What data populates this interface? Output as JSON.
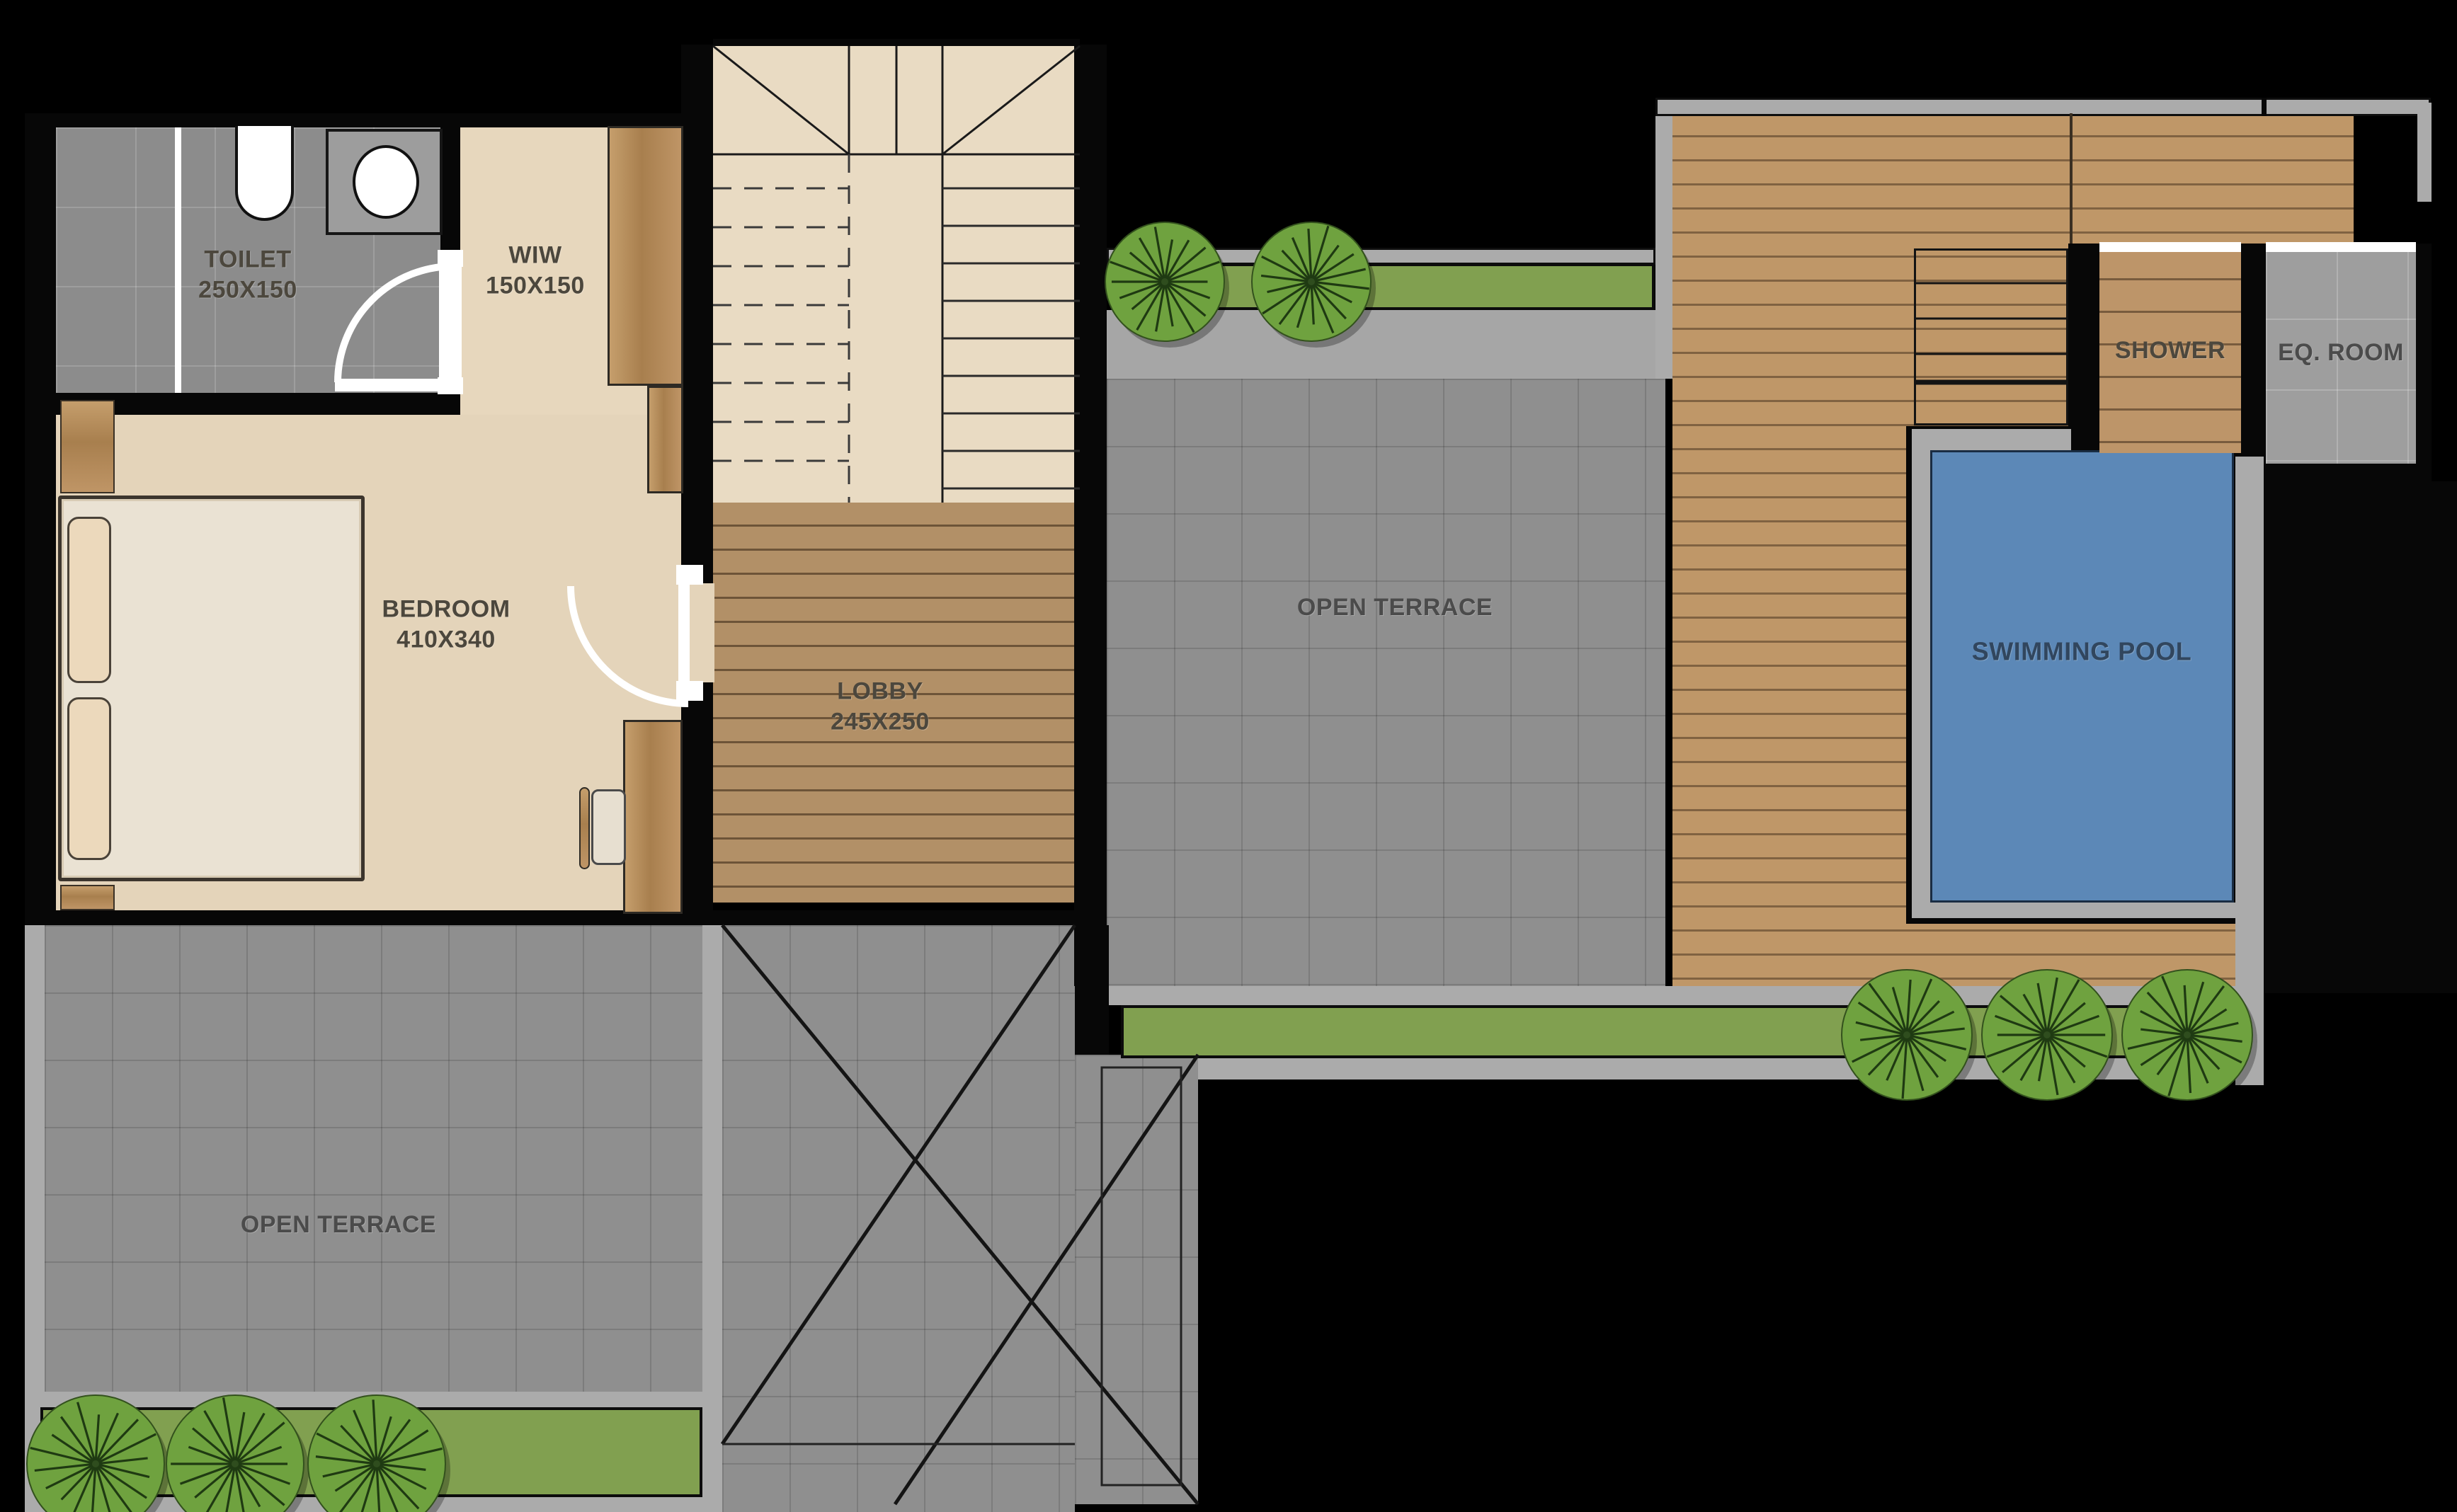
{
  "rooms": {
    "toilet": {
      "label": "TOILET",
      "dimensions": "250X150"
    },
    "wiw": {
      "label": "WIW",
      "dimensions": "150X150"
    },
    "bedroom": {
      "label": "BEDROOM",
      "dimensions": "410X340"
    },
    "lobby": {
      "label": "LOBBY",
      "dimensions": "245X250"
    },
    "open_terrace_mid": {
      "label": "OPEN TERRACE"
    },
    "open_terrace_left": {
      "label": "OPEN TERRACE"
    },
    "swimming_pool": {
      "label": "SWIMMING POOL"
    },
    "shower": {
      "label": "SHOWER"
    },
    "eq_room": {
      "label": "EQ. ROOM"
    }
  },
  "colors": {
    "background_wall": "#070707",
    "tile_gray": "#8f8f8f",
    "concrete_gray": "#ababab",
    "deck_wood": "#bf9768",
    "lobby_wood": "#b29067",
    "floor_beige": "#e7d7bd",
    "planter_green": "#81a050",
    "tree_green": "#6fa23f",
    "pool_blue": "#5c88b7",
    "label_dark": "#4c473d",
    "pool_label": "#31465e"
  },
  "landscape": {
    "trees_top_count": 2,
    "trees_bottom_middle_count": 3,
    "trees_bottom_left_count": 3
  }
}
